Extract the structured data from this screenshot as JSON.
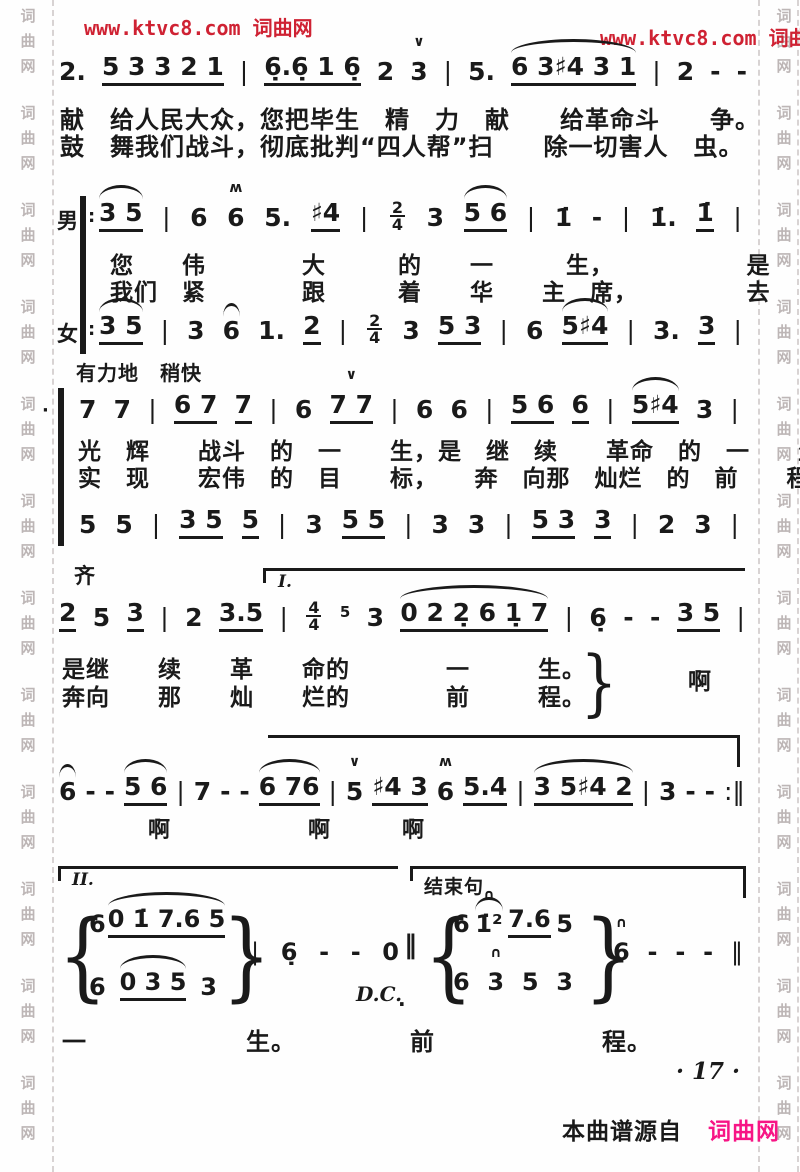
{
  "watermarks": {
    "top_left": "www.ktvc8.com 词曲网",
    "top_right": "www.ktvc8.com 词曲网",
    "side_chars": [
      "词",
      "曲",
      "网"
    ]
  },
  "colors": {
    "ink": "#1a1a1a",
    "watermark_red": "#cf2233",
    "footer_pink": "#f71585",
    "side_gray": "#bdb6b6",
    "background": "#fefefe"
  },
  "markers": {
    "male": "男",
    "female": "女",
    "unison": "齐",
    "tempo": "有力地　稍快",
    "volta1": "I.",
    "volta2": "II.",
    "ending": "结束句",
    "dc": "D.C.",
    "repeat_dots": ":",
    "low_dot": "·",
    "double_bar": "‖",
    "brace_open": "{",
    "brace_close": "}"
  },
  "score": {
    "lines": {
      "l1": [
        {
          "t": "2."
        },
        {
          "t": "5 3 3 2 1",
          "u": 1
        },
        {
          "t": "|",
          "barline": 1
        },
        {
          "t": "6̣.6̣ 1 6̣",
          "u": 1
        },
        {
          "t": "2"
        },
        {
          "t": "3",
          "a": "∨"
        },
        {
          "t": "|",
          "barline": 1
        },
        {
          "t": "5."
        },
        {
          "t": "6 3♯4 3 1",
          "u": 1,
          "s": 1
        },
        {
          "t": "|",
          "barline": 1
        },
        {
          "t": "2"
        },
        {
          "t": "-"
        },
        {
          "t": "-"
        }
      ],
      "l2": [
        {
          "t": "3 5",
          "u": 1,
          "s": 1
        },
        {
          "t": "|",
          "barline": 1
        },
        {
          "t": "6"
        },
        {
          "t": "6",
          "a": "ʍ"
        },
        {
          "t": "5."
        },
        {
          "t": "♯4",
          "u": 1
        },
        {
          "t": "|",
          "barline": 1
        },
        {
          "f": "2/4"
        },
        {
          "t": "3"
        },
        {
          "t": "5 6",
          "u": 1,
          "s": 1
        },
        {
          "t": "|",
          "barline": 1
        },
        {
          "t": "1̇"
        },
        {
          "t": "-"
        },
        {
          "t": "|",
          "barline": 1
        },
        {
          "t": "1̇."
        },
        {
          "t": "1̇",
          "u": 1
        },
        {
          "t": "|",
          "barline": 1
        }
      ],
      "l3": [
        {
          "t": "3 5",
          "u": 1,
          "s": 1
        },
        {
          "t": "|",
          "barline": 1
        },
        {
          "t": "3"
        },
        {
          "t": "6",
          "s": 1
        },
        {
          "t": "1."
        },
        {
          "t": "2",
          "u": 1
        },
        {
          "t": "|",
          "barline": 1
        },
        {
          "f": "2/4"
        },
        {
          "t": "3"
        },
        {
          "t": "5 3",
          "u": 1
        },
        {
          "t": "|",
          "barline": 1
        },
        {
          "t": "6"
        },
        {
          "t": "5♯4",
          "u": 1,
          "s": 1
        },
        {
          "t": "|",
          "barline": 1
        },
        {
          "t": "3."
        },
        {
          "t": "3",
          "u": 1
        },
        {
          "t": "|",
          "barline": 1
        }
      ],
      "l4": [
        {
          "t": "7"
        },
        {
          "t": "7"
        },
        {
          "t": "|",
          "barline": 1
        },
        {
          "t": "6 7",
          "u": 1
        },
        {
          "t": "7",
          "u": 1
        },
        {
          "t": "|",
          "barline": 1
        },
        {
          "t": "6"
        },
        {
          "t": "7 7",
          "u": 1,
          "a": "∨"
        },
        {
          "t": "|",
          "barline": 1
        },
        {
          "t": "6"
        },
        {
          "t": "6"
        },
        {
          "t": "|",
          "barline": 1
        },
        {
          "t": "5 6",
          "u": 1
        },
        {
          "t": "6",
          "u": 1
        },
        {
          "t": "|",
          "barline": 1
        },
        {
          "t": "5♯4",
          "u": 1,
          "s": 1
        },
        {
          "t": "3"
        },
        {
          "t": "|",
          "barline": 1
        }
      ],
      "l5": [
        {
          "t": "5"
        },
        {
          "t": "5"
        },
        {
          "t": "|",
          "barline": 1
        },
        {
          "t": "3 5",
          "u": 1
        },
        {
          "t": "5",
          "u": 1
        },
        {
          "t": "|",
          "barline": 1
        },
        {
          "t": "3"
        },
        {
          "t": "5 5",
          "u": 1
        },
        {
          "t": "|",
          "barline": 1
        },
        {
          "t": "3"
        },
        {
          "t": "3"
        },
        {
          "t": "|",
          "barline": 1
        },
        {
          "t": "5 3",
          "u": 1
        },
        {
          "t": "3",
          "u": 1
        },
        {
          "t": "|",
          "barline": 1
        },
        {
          "t": "2"
        },
        {
          "t": "3"
        },
        {
          "t": "|",
          "barline": 1
        }
      ],
      "l6": [
        {
          "t": "2",
          "u": 1
        },
        {
          "t": "5"
        },
        {
          "t": "3",
          "u": 1
        },
        {
          "t": "|",
          "barline": 1
        },
        {
          "t": "2"
        },
        {
          "t": "3.5",
          "u": 1
        },
        {
          "t": "|",
          "barline": 1
        },
        {
          "f": "4/4"
        },
        {
          "t": "5",
          "sm": 1
        },
        {
          "t": "3"
        },
        {
          "t": "0 2 2̣ 6 1̣ 7",
          "u": 1,
          "s": 1
        },
        {
          "t": "|",
          "barline": 1
        },
        {
          "t": "6̣"
        },
        {
          "t": "-"
        },
        {
          "t": "-"
        },
        {
          "t": "3 5",
          "u": 1
        },
        {
          "t": "|",
          "barline": 1
        }
      ],
      "l7": [
        {
          "t": "6",
          "s": 1
        },
        {
          "t": "-"
        },
        {
          "t": "-"
        },
        {
          "t": "5 6",
          "u": 1,
          "s": 1
        },
        {
          "t": "|",
          "barline": 1
        },
        {
          "t": "7"
        },
        {
          "t": "-"
        },
        {
          "t": "-"
        },
        {
          "t": "6 76",
          "u": 1,
          "s": 1
        },
        {
          "t": "|",
          "barline": 1
        },
        {
          "t": "5",
          "a": "∨"
        },
        {
          "t": "♯4 3",
          "u": 1
        },
        {
          "t": "6",
          "a": "ʍ"
        },
        {
          "t": "5.4",
          "u": 1
        },
        {
          "t": "|",
          "barline": 1
        },
        {
          "t": "3 5♯4 2",
          "u": 1,
          "s": 1
        },
        {
          "t": "|",
          "barline": 1
        },
        {
          "t": "3"
        },
        {
          "t": "-"
        },
        {
          "t": "-"
        },
        {
          "t": ":‖",
          "barline": 1
        }
      ],
      "g1t": [
        {
          "t": "6"
        },
        {
          "t": "0 1̇ 7.6 5",
          "u": 1,
          "s": 1
        }
      ],
      "g1b": [
        {
          "t": "6"
        },
        {
          "t": "0 3 5",
          "u": 1,
          "s": 1
        },
        {
          "t": "3"
        }
      ],
      "mid": [
        {
          "t": "|",
          "barline": 1
        },
        {
          "t": "6̣"
        },
        {
          "t": "-"
        },
        {
          "t": "-"
        },
        {
          "t": "0"
        }
      ],
      "g2t": [
        {
          "t": "6"
        },
        {
          "t": "1̇²",
          "a": "∩",
          "s": 1
        },
        {
          "t": "7.6",
          "u": 1
        },
        {
          "t": "5"
        }
      ],
      "g2b": [
        {
          "t": "6"
        },
        {
          "t": "3",
          "a": "∩"
        },
        {
          "t": "5"
        },
        {
          "t": "3"
        }
      ],
      "end": [
        {
          "t": "6",
          "a": "∩"
        },
        {
          "t": "-"
        },
        {
          "t": "-"
        },
        {
          "t": "-"
        },
        {
          "t": "‖",
          "barline": 1
        }
      ]
    }
  },
  "lyrics": {
    "v1a": "献　给人民大众，您把毕生　精　力　献　　给革命斗　　争。",
    "v1b": "鼓　舞我们战斗，彻底批判“四人帮”扫　　除一切害人　虫。",
    "ma": "您　　伟　　　　大　　　的　　一　　　生，　　　　　　是",
    "mb": "我们　紧　　　　跟　　　着　　华　　主　席，　　　　　去",
    "da": "光　辉　　战斗　的　一　　生，是　继　续　　革命　的　一　　生，",
    "db": "实　现　　宏伟　的　目　　标，　　奔　向那　灿烂　的　前　　程，",
    "ua": "是继　　续　　革　　命的　　　　一",
    "ua2": "生。",
    "ub": "奔向　　那　　灿　　烂的　　　　前",
    "ub2": "程。",
    "ah0": "啊",
    "ah1": "啊",
    "ah2": "啊",
    "ah3": "啊",
    "fa": "一",
    "fa2": "生。",
    "fb": "前",
    "fb2": "程。"
  },
  "footer": {
    "page": "· 17 ·",
    "source_prefix": "本曲谱源自",
    "source_site": "词曲网"
  }
}
